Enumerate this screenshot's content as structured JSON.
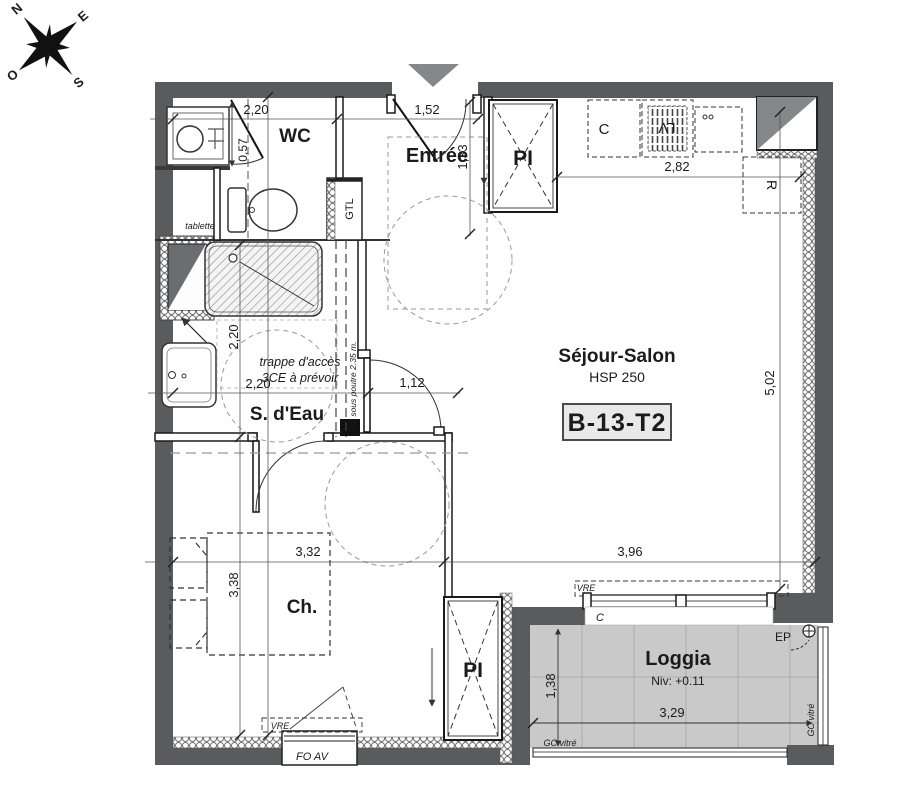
{
  "colors": {
    "wall": "#595b5d",
    "duct_gray": "#85888a",
    "loggia_floor": "#c9c9c9",
    "badge_bg": "#e9e9e9"
  },
  "compass": {
    "north": "N",
    "east": "E",
    "south": "S",
    "west": "O"
  },
  "rooms": {
    "wc": {
      "name": "WC",
      "dim_width": "2,20",
      "dim_basin": "0,57",
      "shelf": "tablette",
      "gtl": "GTL"
    },
    "entree": {
      "name": "Entrée",
      "dim_width": "1,52",
      "dim_depth": "1,33"
    },
    "bathroom": {
      "name": "S. d'Eau",
      "dim_width": "2,20",
      "dim_depth": "2,20",
      "dim_door": "1,12",
      "note_line1": "trappe d'accès",
      "note_line2": "3CE à prévoir",
      "beam_note": "ht. sous poutre 2.35 m."
    },
    "living": {
      "name": "Séjour-Salon",
      "ceiling": "HSP 250",
      "unit_badge": "B-13-T2",
      "dim_depth": "5,02",
      "dim_width": "3,96"
    },
    "bedroom": {
      "name": "Ch.",
      "dim_width": "3,32",
      "dim_depth": "3,38",
      "window_label": "FO AV",
      "shutter_label": "VRE"
    },
    "loggia": {
      "name": "Loggia",
      "level": "Niv: +0.11",
      "dim_width": "3,29",
      "dim_depth": "1,38",
      "downpipe": "EP",
      "glass_rail_bottom": "GC vitré",
      "glass_rail_right": "GC vitré",
      "shutter_label": "VRE",
      "sill_label": "C"
    }
  },
  "kitchen": {
    "dim_width": "2,82",
    "counter": "C",
    "dishwasher": "LV",
    "fridge": "R"
  },
  "closets": {
    "entry": "PI",
    "bedroom": "PI"
  }
}
